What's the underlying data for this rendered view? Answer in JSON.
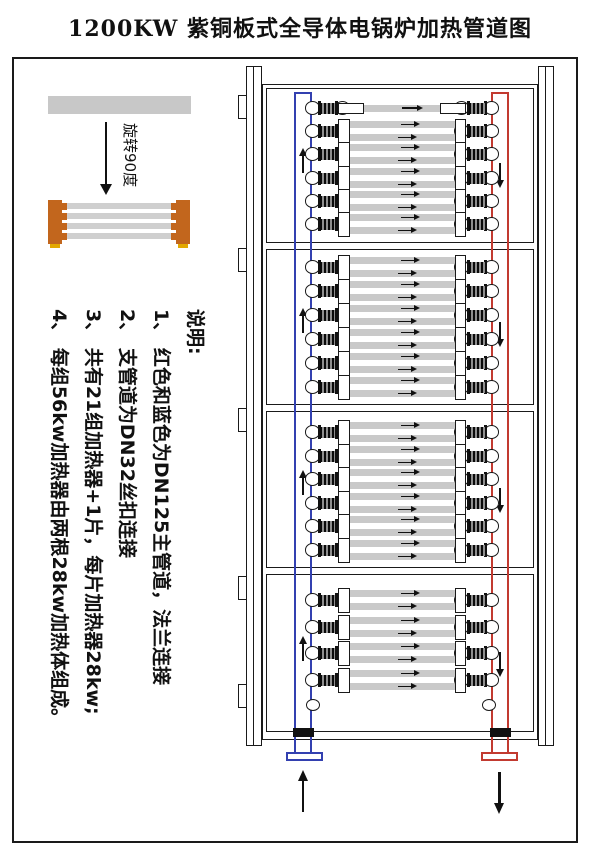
{
  "title": "1200KW 紫铜板式全导体电锅炉加热管道图",
  "orientation_hint": {
    "rotate_label": "旋转90度"
  },
  "notes": {
    "heading": "说明:",
    "items": [
      "1、 红色和蓝色为DN125主管道，法兰连接",
      "2、 支管道为DN32丝扣连接",
      "3、 共有21组加热器+1片，每片加热器28kw;",
      "4、 每组56kw加热器由两根28kw加热体组成。"
    ]
  },
  "colors": {
    "pipe_blue": "#3340b0",
    "pipe_red": "#c23a30",
    "heater_gray": "#c9c9c9",
    "copper_orange": "#c2661d",
    "foot_yellow": "#e3a800",
    "line_black": "#1a1a1a"
  },
  "cabinet": {
    "left_tabs_y": [
      95,
      248,
      408,
      576,
      684
    ],
    "sections": [
      {
        "name": "section-1",
        "top": 88,
        "height": 155,
        "blue_arrow_y": 148,
        "red_arrow_y": 163,
        "rows": [
          {
            "type": "single",
            "cy": 108
          },
          {
            "type": "double",
            "cy": 131
          },
          {
            "type": "double",
            "cy": 154
          },
          {
            "type": "double",
            "cy": 178
          },
          {
            "type": "double",
            "cy": 201
          },
          {
            "type": "double",
            "cy": 224
          }
        ]
      },
      {
        "name": "section-2",
        "top": 249,
        "height": 156,
        "blue_arrow_y": 308,
        "red_arrow_y": 322,
        "rows": [
          {
            "type": "double",
            "cy": 267
          },
          {
            "type": "double",
            "cy": 291
          },
          {
            "type": "double",
            "cy": 315
          },
          {
            "type": "double",
            "cy": 339
          },
          {
            "type": "double",
            "cy": 363
          },
          {
            "type": "double",
            "cy": 387
          }
        ]
      },
      {
        "name": "section-3",
        "top": 411,
        "height": 157,
        "blue_arrow_y": 470,
        "red_arrow_y": 488,
        "rows": [
          {
            "type": "double",
            "cy": 432
          },
          {
            "type": "double",
            "cy": 456
          },
          {
            "type": "double",
            "cy": 479
          },
          {
            "type": "double",
            "cy": 503
          },
          {
            "type": "double",
            "cy": 526
          },
          {
            "type": "double",
            "cy": 550
          }
        ]
      },
      {
        "name": "section-4",
        "top": 574,
        "height": 158,
        "blue_arrow_y": 636,
        "red_arrow_y": 652,
        "caps_cy": 705,
        "rows": [
          {
            "type": "double",
            "cy": 600
          },
          {
            "type": "double",
            "cy": 627
          },
          {
            "type": "double",
            "cy": 653
          },
          {
            "type": "double",
            "cy": 680
          }
        ]
      }
    ]
  }
}
